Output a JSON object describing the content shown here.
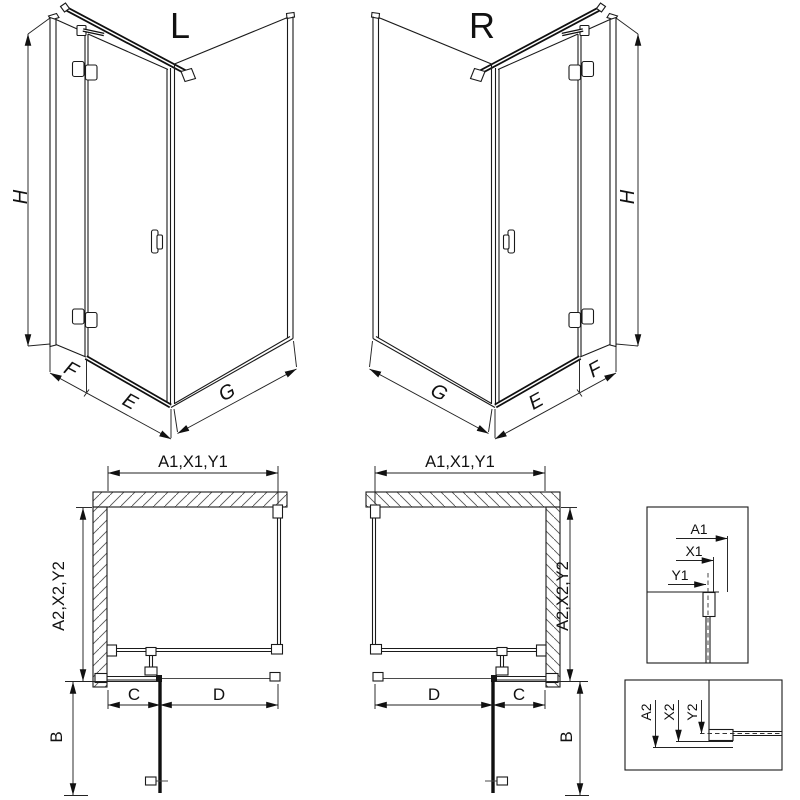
{
  "iso_views": {
    "left": {
      "title": "L",
      "height": "H",
      "fixed_width": "F",
      "door_width": "E",
      "side_width": "G"
    },
    "right": {
      "title": "R",
      "height": "H",
      "fixed_width": "F",
      "door_width": "E",
      "side_width": "G"
    }
  },
  "plan_views": {
    "left": {
      "width_total": "A1,X1,Y1",
      "depth_total": "A2,X2,Y2",
      "seg_wall_to_hinge": "C",
      "seg_hinge_to_corner": "D",
      "door_open_depth": "B"
    },
    "right": {
      "width_total": "A1,X1,Y1",
      "depth_total": "A2,X2,Y2",
      "seg_wall_to_hinge": "C",
      "seg_hinge_to_corner": "D",
      "door_open_depth": "B"
    }
  },
  "details": {
    "wall_profile": {
      "labels": [
        "A1",
        "X1",
        "Y1"
      ]
    },
    "floor_profile": {
      "labels": [
        "A2",
        "X2",
        "Y2"
      ]
    }
  },
  "colors": {
    "line": "#1a1a1a",
    "dimension": "#222222",
    "hatch": "#555555",
    "background": "#ffffff"
  }
}
